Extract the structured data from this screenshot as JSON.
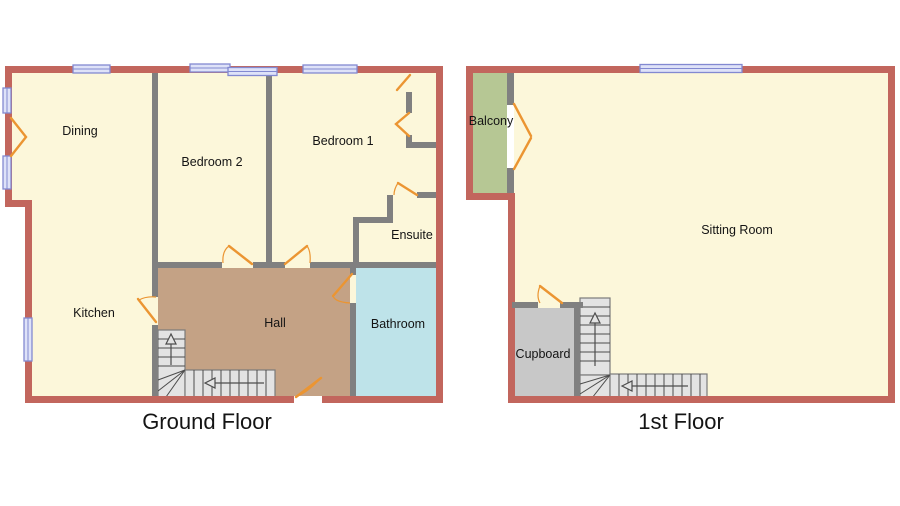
{
  "palette": {
    "exterior_wall": "#c2665d",
    "interior_wall": "#808080",
    "room_fill": "#fcf7da",
    "hall_fill": "#c4a285",
    "bathroom_fill": "#bee3e9",
    "balcony_fill": "#b6c794",
    "cupboard_fill": "#c8c8c8",
    "stairs_fill": "#e3e3e3",
    "stairs_line": "#4d4d4d",
    "window_fill": "#dee2f8",
    "window_border": "#8289d1",
    "door": "#eb9532",
    "label_color": "#141414"
  },
  "floors": {
    "ground": {
      "title": "Ground Floor",
      "rooms": {
        "dining": "Dining",
        "bedroom2": "Bedroom 2",
        "bedroom1": "Bedroom 1",
        "ensuite": "Ensuite",
        "kitchen": "Kitchen",
        "hall": "Hall",
        "bathroom": "Bathroom"
      }
    },
    "first": {
      "title": "1st Floor",
      "rooms": {
        "balcony": "Balcony",
        "sitting_room": "Sitting Room",
        "cupboard": "Cupboard"
      }
    }
  }
}
